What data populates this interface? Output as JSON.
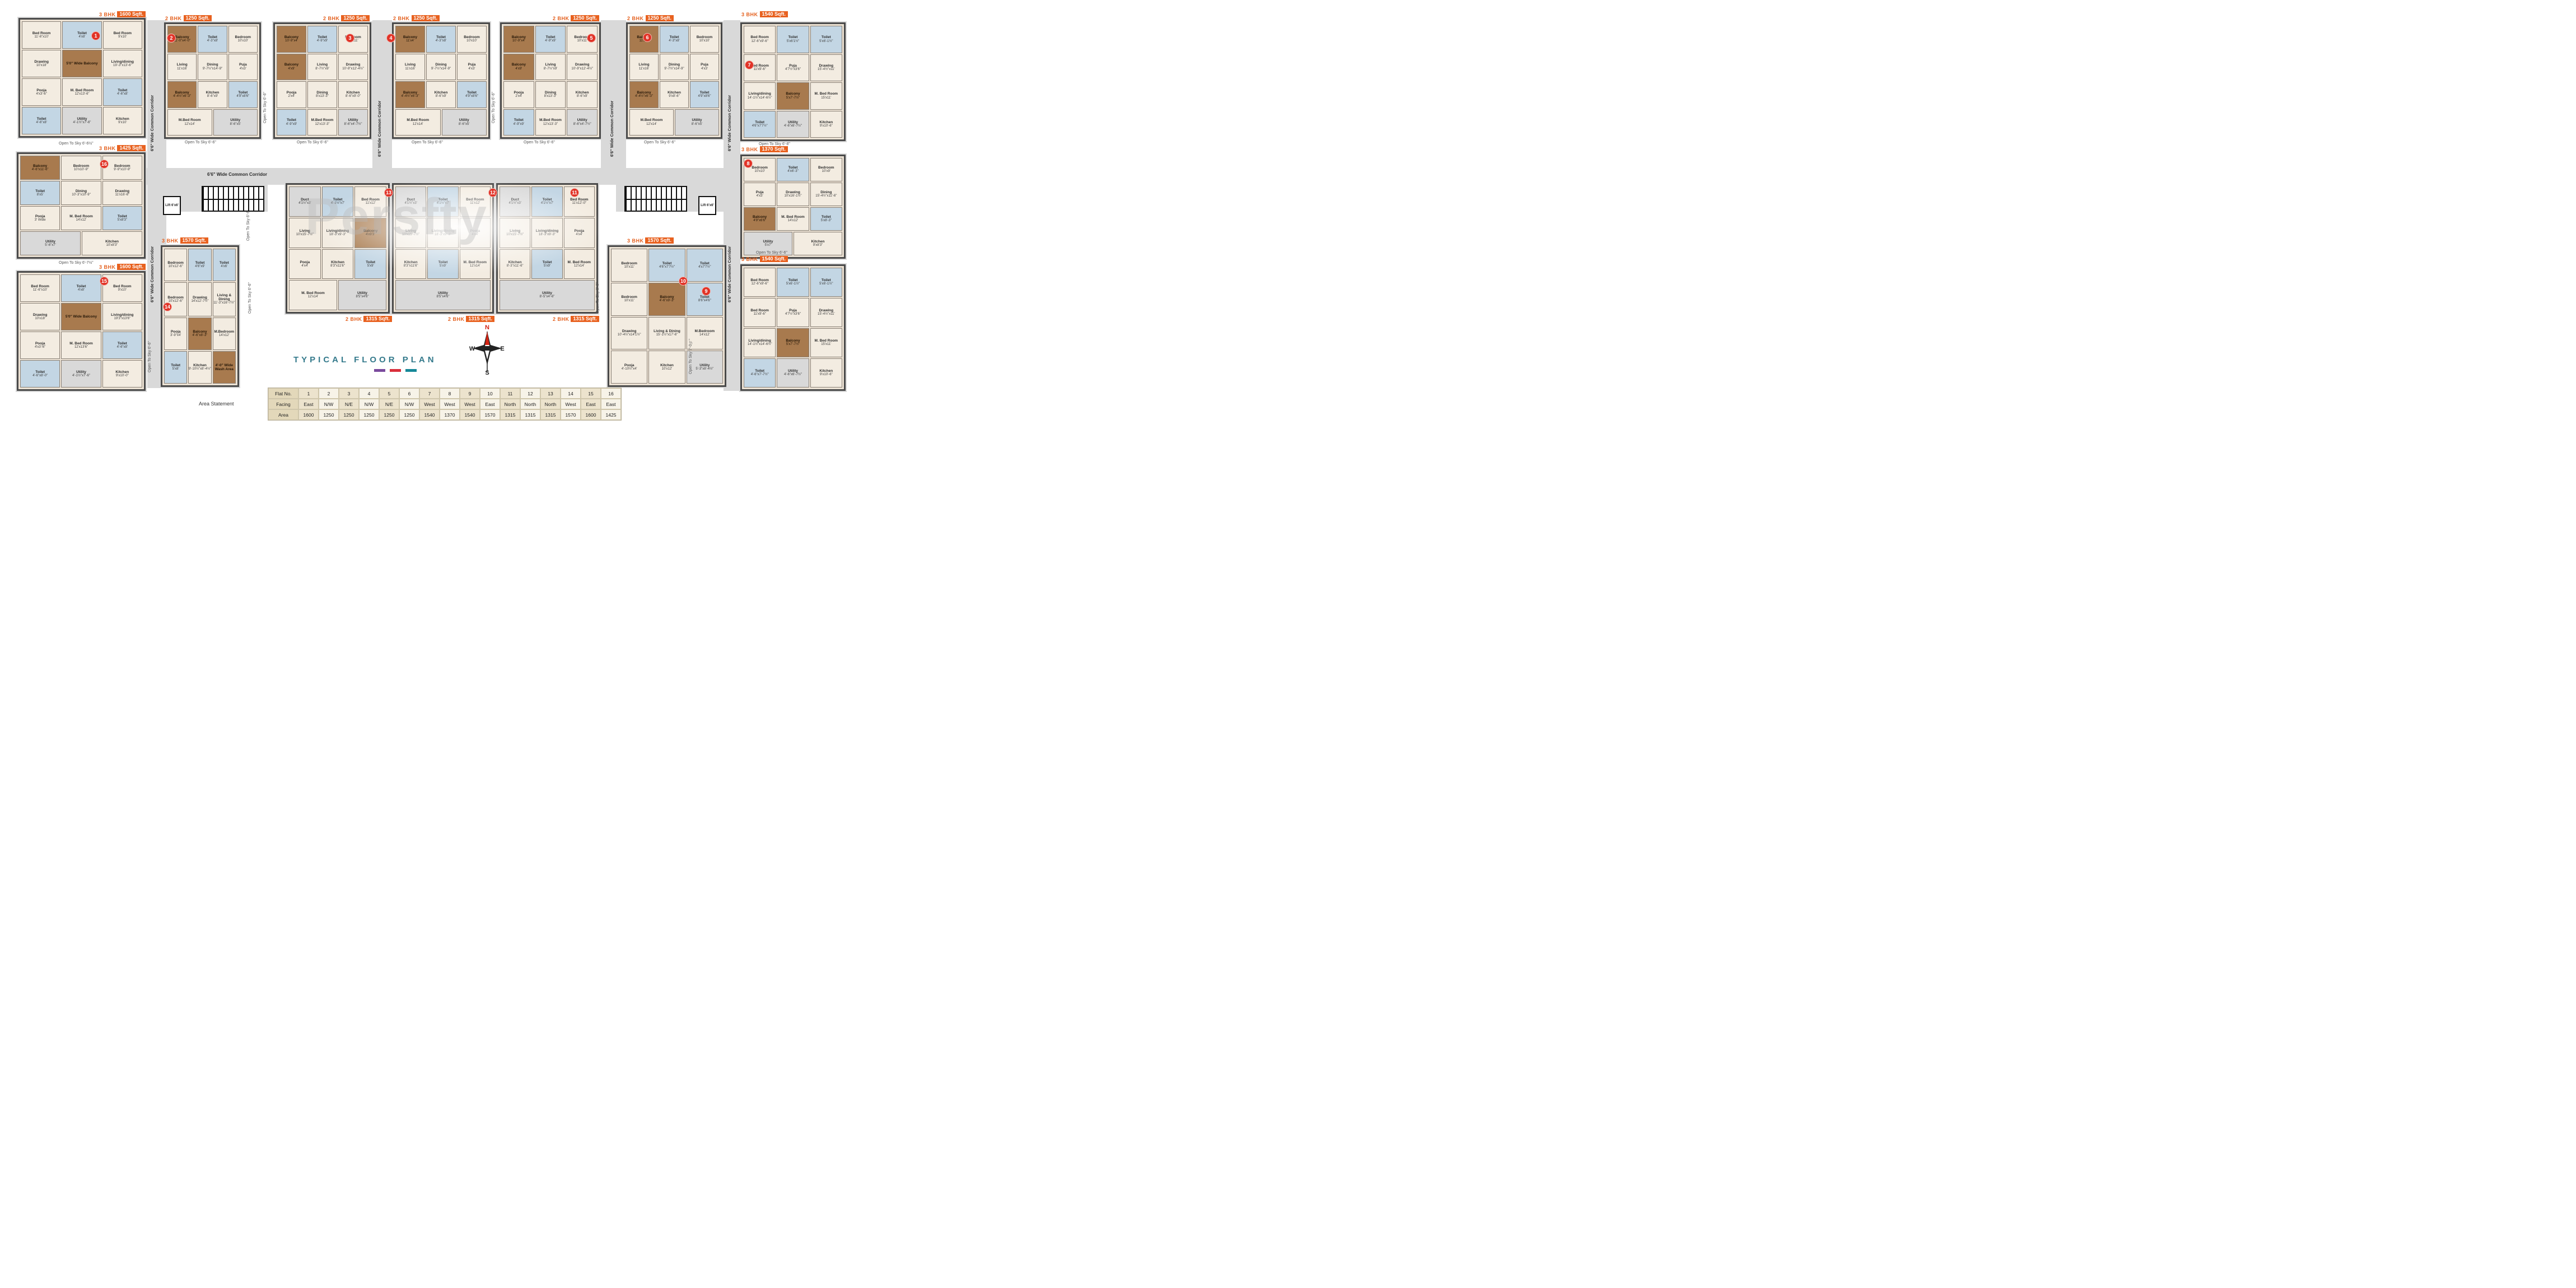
{
  "watermark": "Persfty",
  "title": {
    "text": "TYPICAL FLOOR PLAN",
    "underline_colors": [
      "#7a4a9d",
      "#d92f3c",
      "#168898"
    ]
  },
  "labels": {
    "corridor": "6'6\" Wide Common Corridor",
    "lift": "Lift 6'x6'",
    "area_statement": "Area Statement"
  },
  "compass": {
    "n": "N",
    "e": "E",
    "s": "S",
    "w": "W"
  },
  "open_to_sky": [
    "Open To Sky 6'-6½\"",
    "Open To Sky 6'-6\"",
    "Open To Sky 6'-6\"",
    "Open To Sky 6'-6\"",
    "Open To Sky 6'-6\"",
    "Open To Sky 6'-6\"",
    "Open To Sky 6'-8\"",
    "Open To Sky 6'-6\"",
    "Open To Sky 6'-6\"",
    "Open To Sky 6'-7½\"",
    "Open To Sky 6'-6\"",
    "Open To Sky 6'-6\"",
    "Open To Sky 6'-6\"",
    "Open To Sky 6'-6\"",
    "Open To Sky 7'-0½\"",
    "Open To Sky 6'-6\""
  ],
  "table": {
    "row_headers": [
      "Flat No.",
      "Facing",
      "Area"
    ],
    "flat_no": [
      "1",
      "2",
      "3",
      "4",
      "5",
      "6",
      "7",
      "8",
      "9",
      "10",
      "11",
      "12",
      "13",
      "14",
      "15",
      "16"
    ],
    "facing": [
      "East",
      "N/W",
      "N/E",
      "N/W",
      "N/E",
      "N/W",
      "West",
      "West",
      "West",
      "East",
      "North",
      "North",
      "North",
      "West",
      "East",
      "East"
    ],
    "area": [
      "1600",
      "1250",
      "1250",
      "1250",
      "1250",
      "1250",
      "1540",
      "1370",
      "1540",
      "1570",
      "1315",
      "1315",
      "1315",
      "1570",
      "1600",
      "1425"
    ]
  },
  "units": [
    {
      "flat": "1",
      "type": "3 BHK",
      "sqft": "1600 Sqft.",
      "rooms": [
        {
          "n": "Bed Room",
          "d": "11'-6\"x10'"
        },
        {
          "n": "Toilet",
          "d": "4'x8'"
        },
        {
          "n": "Bed Room",
          "d": "9'x10'"
        },
        {
          "n": "Drawing",
          "d": "10'x18'"
        },
        {
          "n": "5'0\" Wide Balcony",
          "d": ""
        },
        {
          "n": "Living/dining",
          "d": "19'-3\"x13'-6\""
        },
        {
          "n": "Pooja",
          "d": "4'x3'-6\""
        },
        {
          "n": "M. Bed Room",
          "d": "12'x13'-6\""
        },
        {
          "n": "Toilet",
          "d": "4'-6\"x8'"
        },
        {
          "n": "Toilet",
          "d": "4'-6\"x8'"
        },
        {
          "n": "Utility",
          "d": "4'-1½\"x7'-6\""
        },
        {
          "n": "Kitchen",
          "d": "9'x10'"
        }
      ]
    },
    {
      "flat": "2",
      "type": "2 BHK",
      "sqft": "1250 Sqft.",
      "rooms": [
        {
          "n": "Balcony",
          "d": "11'-0\"x4'-0\""
        },
        {
          "n": "Toilet",
          "d": "4'-3\"x8'"
        },
        {
          "n": "Bedroom",
          "d": "10'x10'"
        },
        {
          "n": "Living",
          "d": "11'x16'"
        },
        {
          "n": "Dining",
          "d": "9'-7½\"x14'-9\""
        },
        {
          "n": "Puja",
          "d": "4'x3'"
        },
        {
          "n": "Balcony",
          "d": "4'-4½\"x6'-3\""
        },
        {
          "n": "Kitchen",
          "d": "8'-6\"x9'"
        },
        {
          "n": "Toilet",
          "d": "4'9\"x8'6\""
        },
        {
          "n": "M.Bed Room",
          "d": "12'x14'"
        },
        {
          "n": "Utility",
          "d": "8'-6\"x5'"
        }
      ]
    },
    {
      "flat": "3",
      "type": "2 BHK",
      "sqft": "1250 Sqft.",
      "rooms": [
        {
          "n": "Balcony",
          "d": "10'-9\"x4'"
        },
        {
          "n": "Toilet",
          "d": "4'-9\"x9'"
        },
        {
          "n": "Bedroom",
          "d": "10'x11'"
        },
        {
          "n": "Balcony",
          "d": "4'x9'"
        },
        {
          "n": "Living",
          "d": "8'-7½\"x9'"
        },
        {
          "n": "Drawing",
          "d": "10'-9\"x12'-4½\""
        },
        {
          "n": "Pooja",
          "d": "2'x4'"
        },
        {
          "n": "Dining",
          "d": "8'x13'-3\""
        },
        {
          "n": "Kitchen",
          "d": "8'-6\"x9'-0\""
        },
        {
          "n": "Toilet",
          "d": "4'-9\"x9'"
        },
        {
          "n": "M.Bed Room",
          "d": "12'x13'-3\""
        },
        {
          "n": "Utility",
          "d": "8'-6\"x4'-7½\""
        }
      ]
    },
    {
      "flat": "4",
      "type": "2 BHK",
      "sqft": "1250 Sqft.",
      "rooms": [
        {
          "n": "Balcony",
          "d": "11'x4'"
        },
        {
          "n": "Toilet",
          "d": "4'-3\"x8'"
        },
        {
          "n": "Bedroom",
          "d": "10'x10'"
        },
        {
          "n": "Living",
          "d": "11'x16'"
        },
        {
          "n": "Dining",
          "d": "9'-7½\"x14'-9\""
        },
        {
          "n": "Puja",
          "d": "4'x3'"
        },
        {
          "n": "Balcony",
          "d": "4'-4½\"x6'-3\""
        },
        {
          "n": "Kitchen",
          "d": "8'-6\"x9'"
        },
        {
          "n": "Toilet",
          "d": "4'9\"x8'6\""
        },
        {
          "n": "M.Bed Room",
          "d": "12'x14'"
        },
        {
          "n": "Utility",
          "d": "8'-6\"x5'"
        }
      ]
    },
    {
      "flat": "5",
      "type": "2 BHK",
      "sqft": "1250 Sqft.",
      "rooms": [
        {
          "n": "Balcony",
          "d": "10'-9\"x4'"
        },
        {
          "n": "Toilet",
          "d": "4'-9\"x9'"
        },
        {
          "n": "Bedroom",
          "d": "10'x11'"
        },
        {
          "n": "Balcony",
          "d": "4'x9'"
        },
        {
          "n": "Living",
          "d": "8'-7½\"x9'"
        },
        {
          "n": "Drawing",
          "d": "10'-9\"x12'-4½\""
        },
        {
          "n": "Pooja",
          "d": "2'x4'"
        },
        {
          "n": "Dining",
          "d": "8'x13'-3\""
        },
        {
          "n": "Kitchen",
          "d": "8'-6\"x9'"
        },
        {
          "n": "Toilet",
          "d": "4'-9\"x9'"
        },
        {
          "n": "M.Bed Room",
          "d": "12'x13'-3\""
        },
        {
          "n": "Utility",
          "d": "8'-6\"x4'-7½\""
        }
      ]
    },
    {
      "flat": "6",
      "type": "2 BHK",
      "sqft": "1250 Sqft.",
      "rooms": [
        {
          "n": "Balcony",
          "d": "11'x4'\""
        },
        {
          "n": "Toilet",
          "d": "4'-3\"x8'"
        },
        {
          "n": "Bedroom",
          "d": "10'x10'"
        },
        {
          "n": "Living",
          "d": "11'x16'"
        },
        {
          "n": "Dining",
          "d": "9'-7½\"x14'-9\""
        },
        {
          "n": "Puja",
          "d": "4'x3'"
        },
        {
          "n": "Balcony",
          "d": "4'-4½\"x6'-3\""
        },
        {
          "n": "Kitchen",
          "d": "9'x8'-6\""
        },
        {
          "n": "Toilet",
          "d": "4'9\"x8'6\""
        },
        {
          "n": "M.Bed Room",
          "d": "12'x14'"
        },
        {
          "n": "Utility",
          "d": "8'-6\"x5'"
        }
      ]
    },
    {
      "flat": "7",
      "type": "3 BHK",
      "sqft": "1540 Sqft.",
      "rooms": [
        {
          "n": "Bed Room",
          "d": "12'-6\"x9'-6\""
        },
        {
          "n": "Toilet",
          "d": "5'x6'1½\""
        },
        {
          "n": "Toilet",
          "d": "5'x6'-1½\""
        },
        {
          "n": "Bed Room",
          "d": "11'x9'-6\""
        },
        {
          "n": "Puja",
          "d": "4'7½\"x3'6\""
        },
        {
          "n": "Drawing",
          "d": "15'-4½\"x11'"
        },
        {
          "n": "Living/dining",
          "d": "14'-1½\"x14'-6½\""
        },
        {
          "n": "Balcony",
          "d": "5'x7'-7½\""
        },
        {
          "n": "M. Bed Room",
          "d": "15'x11'"
        },
        {
          "n": "Toilet",
          "d": "4'6\"x7'7½\""
        },
        {
          "n": "Utility",
          "d": "4'-6\"x6'-7½\""
        },
        {
          "n": "Kitchen",
          "d": "9'x10'-6\""
        }
      ]
    },
    {
      "flat": "8",
      "type": "3 BHK",
      "sqft": "1370 Sqft.",
      "rooms": [
        {
          "n": "Bedroom",
          "d": "10'x10'"
        },
        {
          "n": "Toilet",
          "d": "4'x6'-3\""
        },
        {
          "n": "Bedroom",
          "d": "10'x9'"
        },
        {
          "n": "Puja",
          "d": "4'x3'"
        },
        {
          "n": "Drawing",
          "d": "10'x16'-1½\""
        },
        {
          "n": "Dining",
          "d": "15'-4½\"x11'-6\""
        },
        {
          "n": "Balcony",
          "d": "4'9\"x6'6\""
        },
        {
          "n": "M. Bed Room",
          "d": "14'x12'"
        },
        {
          "n": "Toilet",
          "d": "5'x8'-3\""
        },
        {
          "n": "Utility",
          "d": "5'x7'"
        },
        {
          "n": "Kitchen",
          "d": "9'x8'3\""
        }
      ]
    },
    {
      "flat": "9",
      "type": "3 BHK",
      "sqft": "1540 Sqft.",
      "rooms": [
        {
          "n": "Bed Room",
          "d": "12'-6\"x9'-6\""
        },
        {
          "n": "Toilet",
          "d": "5'x6'-1½\""
        },
        {
          "n": "Toilet",
          "d": "5'x6'-1½\""
        },
        {
          "n": "Bed Room",
          "d": "11'x9'-6\""
        },
        {
          "n": "Puja",
          "d": "4'7½\"x3'6\""
        },
        {
          "n": "Drawing",
          "d": "15'-4½\"x11'"
        },
        {
          "n": "Living/dining",
          "d": "14'-1½\"x14'-6½\""
        },
        {
          "n": "Balcony",
          "d": "5'x7'-7½\""
        },
        {
          "n": "M. Bed Room",
          "d": "15'x11'"
        },
        {
          "n": "Toilet",
          "d": "4'-6\"x7'-7½\""
        },
        {
          "n": "Utility",
          "d": "4'-6\"x6'-7½\""
        },
        {
          "n": "Kitchen",
          "d": "9'x10'-6\""
        }
      ]
    },
    {
      "flat": "10",
      "type": "3 BHK",
      "sqft": "1570 Sqft.",
      "rooms": [
        {
          "n": "Bedroom",
          "d": "10'x11'"
        },
        {
          "n": "Toilet",
          "d": "4'6\"x7'7½\""
        },
        {
          "n": "Toilet",
          "d": "4'x7'7½\""
        },
        {
          "n": "Bedroom",
          "d": "10'x11'"
        },
        {
          "n": "Balcony",
          "d": "4'-6\"x9'-3\""
        },
        {
          "n": "Toilet",
          "d": "8'6\"x4'6\""
        },
        {
          "n": "Drawing",
          "d": "10'-4½\"x14'1½\""
        },
        {
          "n": "Living & Dining",
          "d": "15'-1½\"x17'-6\""
        },
        {
          "n": "M.Bedroom",
          "d": "14'x12'"
        },
        {
          "n": "Pooja",
          "d": "4'-10½\"x4'"
        },
        {
          "n": "Kitchen",
          "d": "10'x12'"
        },
        {
          "n": "Utility",
          "d": "5'-3\"x8'-4½\""
        }
      ]
    },
    {
      "flat": "11",
      "type": "2 BHK",
      "sqft": "1315 Sqft.",
      "rooms": [
        {
          "n": "Duct",
          "d": "4'1½\"x3'"
        },
        {
          "n": "Toilet",
          "d": "4'1½\"x7'"
        },
        {
          "n": "Bed Room",
          "d": "11'x12'-0\""
        },
        {
          "n": "Living",
          "d": "10'x15'-7½\""
        },
        {
          "n": "Living/dining",
          "d": "18'-3\"x9'-3\""
        },
        {
          "n": "Pooja",
          "d": "4'x4'"
        },
        {
          "n": "Kitchen",
          "d": "8'-3\"x11'-6\""
        },
        {
          "n": "Toilet",
          "d": "5'x9'"
        },
        {
          "n": "M. Bed Room",
          "d": "12'x14'"
        },
        {
          "n": "Utility",
          "d": "8'-5\"x4'-6\""
        }
      ]
    },
    {
      "flat": "12",
      "type": "2 BHK",
      "sqft": "1315 Sqft.",
      "rooms": [
        {
          "n": "Duct",
          "d": "4'1½\"x3'"
        },
        {
          "n": "Toilet",
          "d": "4'1½\"x7'"
        },
        {
          "n": "Bed Room",
          "d": "11'x12'"
        },
        {
          "n": "Living",
          "d": "10'x15'-7½\""
        },
        {
          "n": "Living/dining",
          "d": "18'-3\"x9'-3\""
        },
        {
          "n": "Pooja",
          "d": "4'x4'"
        },
        {
          "n": "Kitchen",
          "d": "8'3\"x11'6\""
        },
        {
          "n": "Toilet",
          "d": "5'x9'"
        },
        {
          "n": "M. Bed Room",
          "d": "12'x14'"
        },
        {
          "n": "Utility",
          "d": "8'5\"x4'6\""
        }
      ]
    },
    {
      "flat": "13",
      "type": "2 BHK",
      "sqft": "1315 Sqft.",
      "rooms": [
        {
          "n": "Duct",
          "d": "4'1½\"x3'"
        },
        {
          "n": "Toilet",
          "d": "4'-1½\"x7'"
        },
        {
          "n": "Bed Room",
          "d": "11'x12'"
        },
        {
          "n": "Living",
          "d": "10'x15'-7½\""
        },
        {
          "n": "Living/dining",
          "d": "18'-3\"x9'-3\""
        },
        {
          "n": "Balcony",
          "d": "4'x9'3\""
        },
        {
          "n": "Pooja",
          "d": "4'x4'"
        },
        {
          "n": "Kitchen",
          "d": "8'3\"x11'6\""
        },
        {
          "n": "Toilet",
          "d": "5'x9'"
        },
        {
          "n": "M. Bed Room",
          "d": "12'x14'"
        },
        {
          "n": "Utility",
          "d": "8'5\"x4'6\""
        }
      ]
    },
    {
      "flat": "14",
      "type": "3 BHK",
      "sqft": "1570 Sqft.",
      "rooms": [
        {
          "n": "Bedroom",
          "d": "10'x12'-6\""
        },
        {
          "n": "Toilet",
          "d": "4'6\"x9'"
        },
        {
          "n": "Toilet",
          "d": "4'x6'"
        },
        {
          "n": "Bedroom",
          "d": "10'x12'-6\""
        },
        {
          "n": "Drawing",
          "d": "14'x12'-7½\""
        },
        {
          "n": "Living & Dining",
          "d": "11'-3\"x16'-7½\""
        },
        {
          "n": "Pooja",
          "d": "3'-9\"x4'"
        },
        {
          "n": "Balcony",
          "d": "4'-6\"x8'-3\""
        },
        {
          "n": "M.Bedroom",
          "d": "14'x12'"
        },
        {
          "n": "Toilet",
          "d": "5'x8'"
        },
        {
          "n": "Kitchen",
          "d": "9'-10½\"x8'-4½\""
        },
        {
          "n": "4'-0\" Wide Wash Area",
          "d": ""
        }
      ]
    },
    {
      "flat": "15",
      "type": "3 BHK",
      "sqft": "1600 Sqft.",
      "rooms": [
        {
          "n": "Bed Room",
          "d": "11'-6\"x10'"
        },
        {
          "n": "Toilet",
          "d": "4'x8'"
        },
        {
          "n": "Bed Room",
          "d": "9'x10'"
        },
        {
          "n": "Drawing",
          "d": "10'x18'"
        },
        {
          "n": "5'0\" Wide Balcony",
          "d": ""
        },
        {
          "n": "Living/dining",
          "d": "19'3\"x13'6\""
        },
        {
          "n": "Pooja",
          "d": "4'x3'-6\""
        },
        {
          "n": "M. Bed Room",
          "d": "12'x13'6\""
        },
        {
          "n": "Toilet",
          "d": "4'-6\"x8'"
        },
        {
          "n": "Toilet",
          "d": "4'-6\"x8'-0\""
        },
        {
          "n": "Utility",
          "d": "4'-1½\"x7'-6\""
        },
        {
          "n": "Kitchen",
          "d": "9'x10'-0\""
        }
      ]
    },
    {
      "flat": "16",
      "type": "3 BHK",
      "sqft": "1425 Sqft.",
      "rooms": [
        {
          "n": "Balcony",
          "d": "4'-6\"x11'-6\""
        },
        {
          "n": "Bedroom",
          "d": "10'x10'-9\""
        },
        {
          "n": "Bedroom",
          "d": "9'-9\"x10'-9\""
        },
        {
          "n": "Toilet",
          "d": "8'x5'"
        },
        {
          "n": "Dining",
          "d": "10'-3\"x10'-9\""
        },
        {
          "n": "Drawing",
          "d": "11'x16'-6\""
        },
        {
          "n": "Pooja",
          "d": "3' Wide"
        },
        {
          "n": "M. Bed Room",
          "d": "14'x12'"
        },
        {
          "n": "Toilet",
          "d": "5'x8'3\""
        },
        {
          "n": "Utility",
          "d": "5'-6\"x7'"
        },
        {
          "n": "Kitchen",
          "d": "10'x8'3\""
        }
      ]
    }
  ]
}
